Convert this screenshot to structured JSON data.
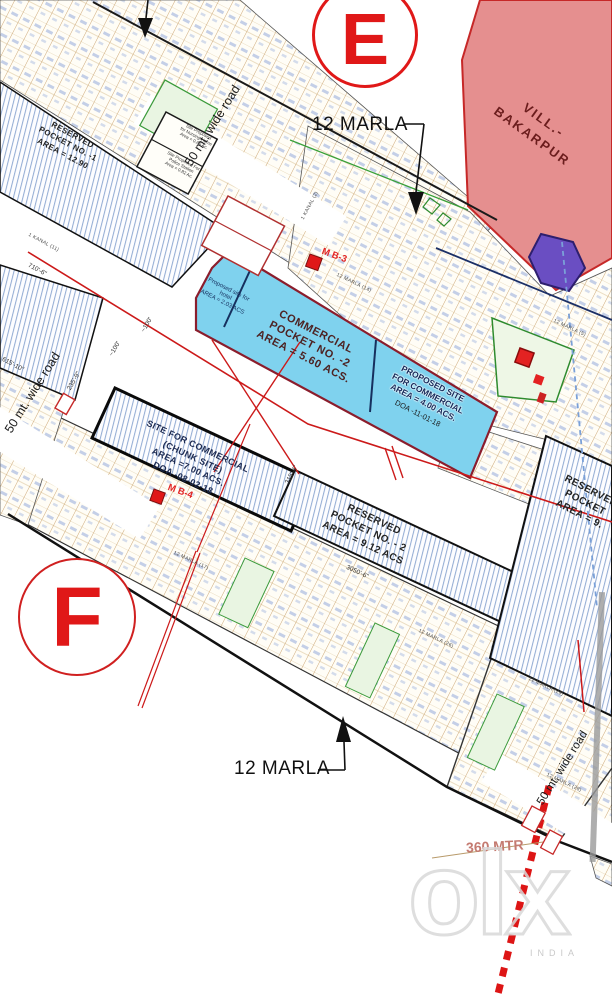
{
  "page": {
    "width": 612,
    "height": 998,
    "type": "sector layout plan"
  },
  "markers": {
    "sector_top": "E",
    "sector_bottom": "F"
  },
  "plot_labels": {
    "top": "12 MARLA",
    "bottom": "12 MARLA"
  },
  "village": {
    "line1": "VILL.-",
    "line2": "BAKARPUR"
  },
  "roads": {
    "r1": "50 mt. wide road",
    "r2": "50 mt. wide road",
    "r3": "50 mt. wide road"
  },
  "commercial": {
    "hotel": {
      "l1": "Proposed site for",
      "l2": "hotel",
      "l3": "AREA = 2.03 ACS"
    },
    "pocket": {
      "l1": "COMMERCIAL",
      "l2": "POCKET NO. -2",
      "l3": "AREA = 5.60 ACS."
    },
    "proposed": {
      "l1": "PROPOSED SITE",
      "l2": "FOR COMMERCIAL",
      "l3": "AREA = 4.00 ACS.",
      "doa": "DOA -11-01-18"
    },
    "chunk": {
      "l1": "SITE FOR COMMERCIAL",
      "l2": "(CHUNK SITE)",
      "l3": "AREA =7.00 ACS.",
      "l4": "DOA -08-02-18"
    }
  },
  "reserved": {
    "p1": {
      "l1": "RESERVED",
      "l2": "POCKET NO. -1",
      "l3": "AREA = 12.90"
    },
    "p2": {
      "l1": "RESERVED",
      "l2": "POCKET NO. - 2",
      "l3": "AREA = 9.12 ACS"
    },
    "right": {
      "l1": "RESERVED",
      "l2": "POCKET",
      "l3": "AREA = 9."
    }
  },
  "site_boxes": {
    "nursing": {
      "l1": "Site Proposed",
      "l2": "for Nursing Home",
      "l3": "Area = 0.66 Ac."
    },
    "police": {
      "l1": "Site Proposed For",
      "l2": "Police Station",
      "l3": "Area = 0.82 Ac."
    }
  },
  "plot_markers": {
    "mb3": "M B-3",
    "mb4": "M B-4"
  },
  "street_labels": [
    "1 KANAL (11)",
    "1 KANAL (2)",
    "12 MARLA (14)",
    "12 MARLA (5)",
    "12 MARLA (17)",
    "12 MARLA (26)",
    "12 MARLA (29)",
    "12 MARLA (28)"
  ],
  "dimensions": [
    "710'-6\"",
    "615'-10\"",
    "235'-9\"",
    "~100'",
    "~100'",
    "3050'-6\"",
    "315'-4\""
  ],
  "distance_note": "360 MTR",
  "watermark": {
    "logo": "olx",
    "country": "INDIA"
  },
  "colors": {
    "pink_village": "#e58f8f",
    "cyan_commercial": "#7fd2ee",
    "hatch_blue": "#8fa9d2",
    "accent_red": "#e01818",
    "maroon_border": "#8b1d2c",
    "navy": "#16305e",
    "green": "#3a9a3a"
  }
}
